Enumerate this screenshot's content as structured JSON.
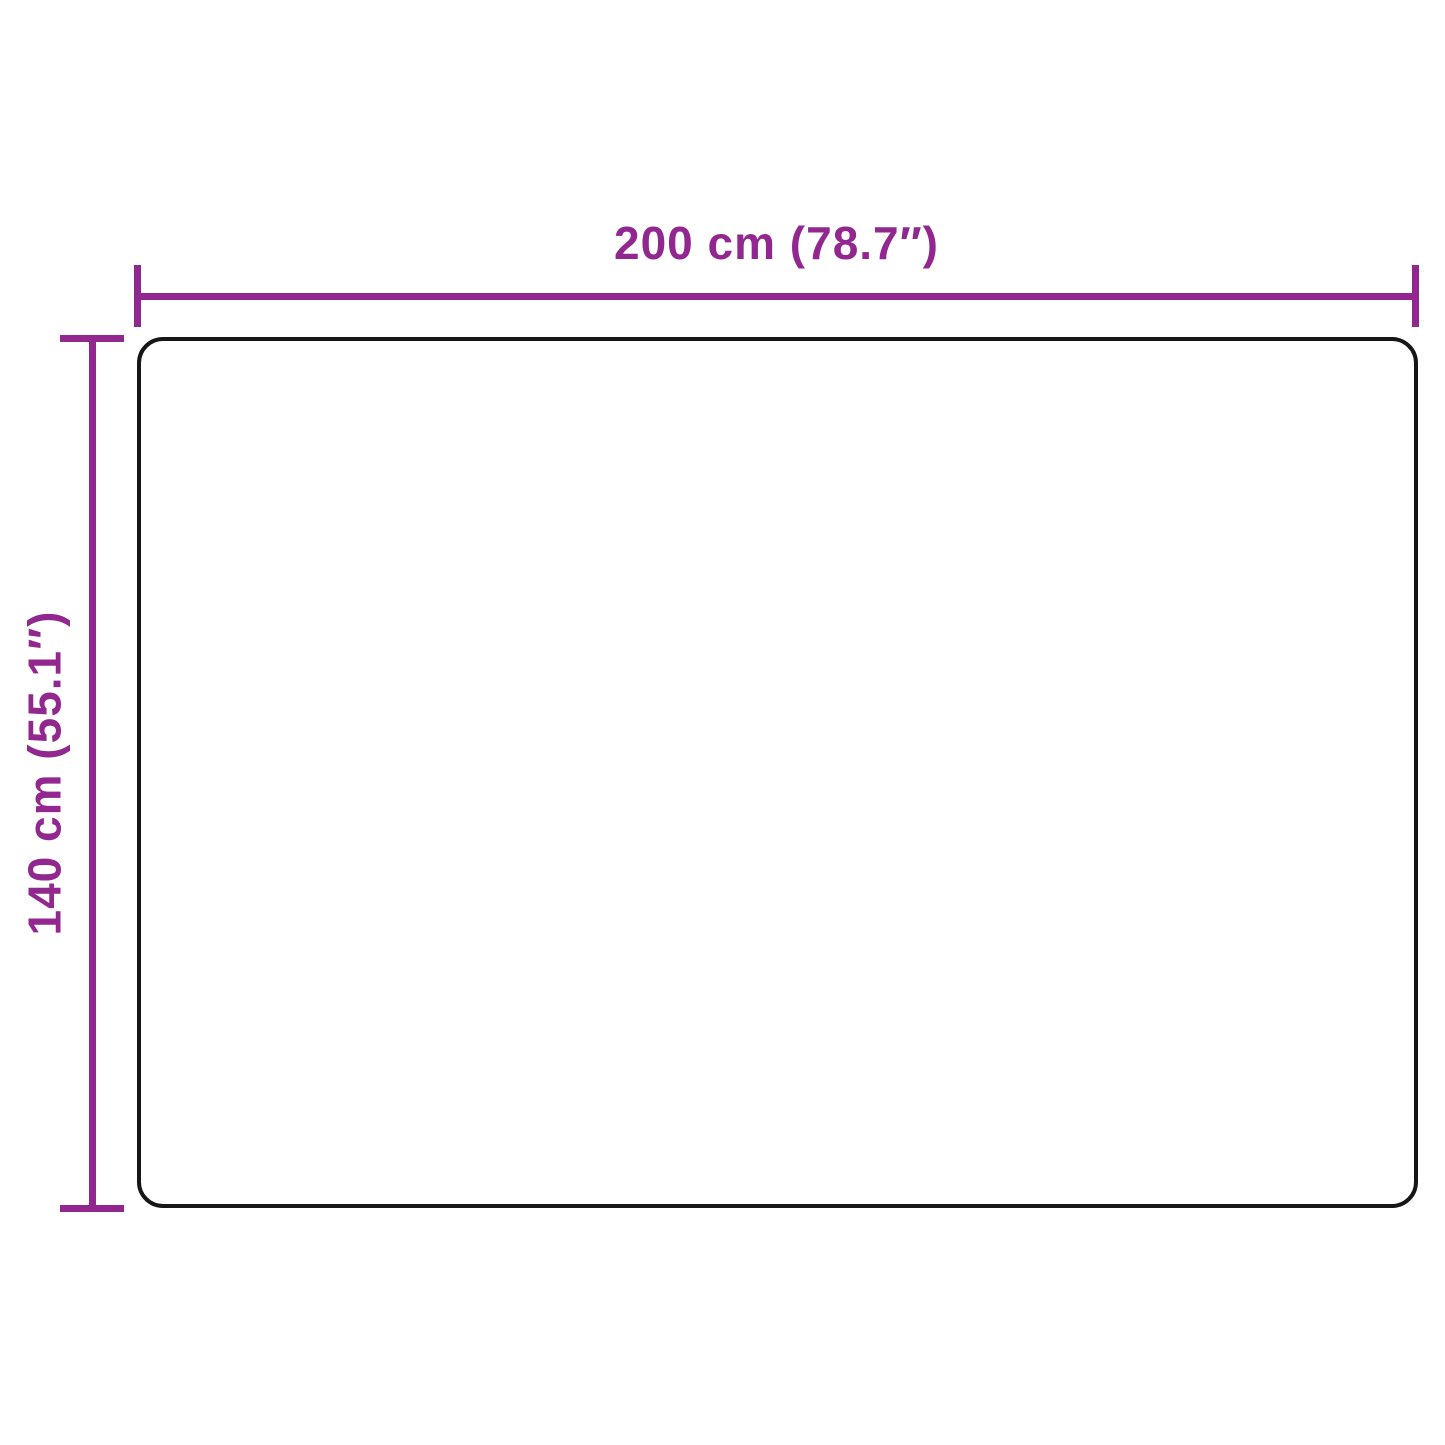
{
  "diagram": {
    "type": "product-dimension-diagram",
    "width": {
      "label": "200 cm (78.7″)",
      "value_cm": 200,
      "value_inch": 78.7
    },
    "height": {
      "label": "140 cm (55.1″)",
      "value_cm": 140,
      "value_inch": 55.1
    }
  },
  "colors": {
    "dimension_accent": "#92278F",
    "product_outline": "#161616",
    "background": "#FFFFFF"
  }
}
